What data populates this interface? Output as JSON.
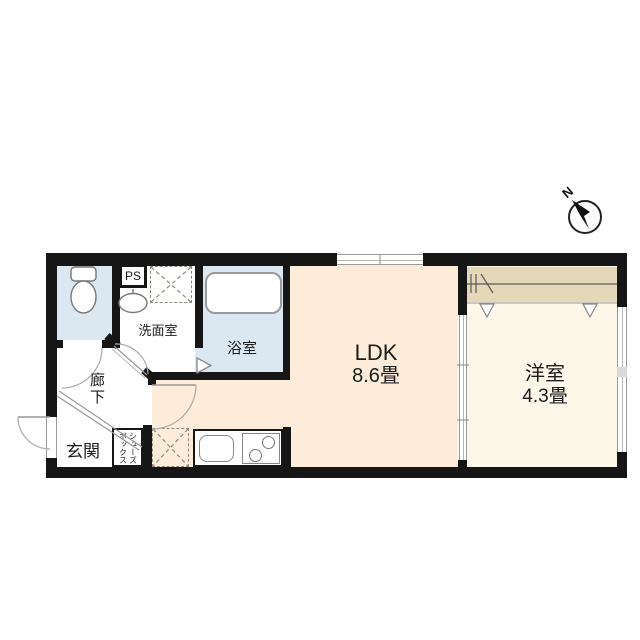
{
  "compass": {
    "label": "N"
  },
  "rooms": {
    "ps": {
      "label": "PS"
    },
    "washroom": {
      "label": "洗面室"
    },
    "bathroom": {
      "label": "浴室"
    },
    "hallway": {
      "label": "廊下"
    },
    "entrance": {
      "label": "玄関"
    },
    "shoe_box": {
      "line1": "シューズ",
      "line2": "ボックス"
    },
    "ldk": {
      "label": "LDK",
      "size": "8.6畳"
    },
    "western_room": {
      "label": "洋室",
      "size": "4.3畳"
    }
  },
  "colors": {
    "wall": "#161616",
    "wet_area": "#dbe8f2",
    "ldk": "#fcecd9",
    "western_room": "#fcf7e8",
    "closet": "#e5d8b8"
  }
}
